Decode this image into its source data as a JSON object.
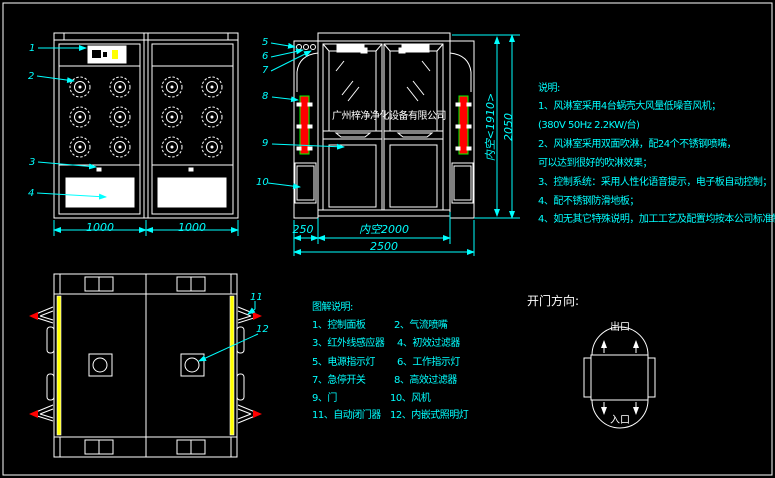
{
  "colors": {
    "background": "#000000",
    "line_white": "#ffffff",
    "accent_cyan": "#00ffff",
    "filter_red": "#ff0000",
    "filter_green_border": "#00ff00",
    "strip_yellow": "#ffff00"
  },
  "watermark": {
    "company": "广州梓净净化设备有限公司"
  },
  "front_view": {
    "dims": {
      "left_width": "1000",
      "right_width": "1000"
    }
  },
  "side_view": {
    "dims": {
      "side_col": "250",
      "inner_width": "内空2000",
      "total_width": "2500",
      "inner_height": "内空<1910>",
      "total_height": "2050"
    }
  },
  "callouts": [
    "1",
    "2",
    "3",
    "4",
    "5",
    "6",
    "7",
    "8",
    "9",
    "10",
    "11",
    "12"
  ],
  "notes": {
    "title": "说明:",
    "lines": [
      "1、风淋室采用4台蜗壳大风量低噪音风机；",
      "(380V  50Hz  2.2KW/台)",
      "2、风淋室采用双面吹淋，配24个不锈钢喷嘴，",
      "可以达到很好的吹淋效果；",
      "3、控制系统：采用人性化语音提示，电子板自动控制；",
      "4、配不锈钢防滑地板；",
      "4、如无其它特殊说明，加工工艺及配置均按本公司标准制作."
    ]
  },
  "legend": {
    "title": "图解说明:",
    "items": [
      "1、控制面板",
      "2、气流喷嘴",
      "3、红外线感应器",
      "4、初效过滤器",
      "5、电源指示灯",
      "6、工作指示灯",
      "7、急停开关",
      "8、高效过滤器",
      "9、门",
      "10、风机",
      "11、自动闭门器",
      "12、内嵌式照明灯"
    ]
  },
  "door_direction": {
    "title": "开门方向:",
    "exit": "出口",
    "entrance": "入口"
  }
}
